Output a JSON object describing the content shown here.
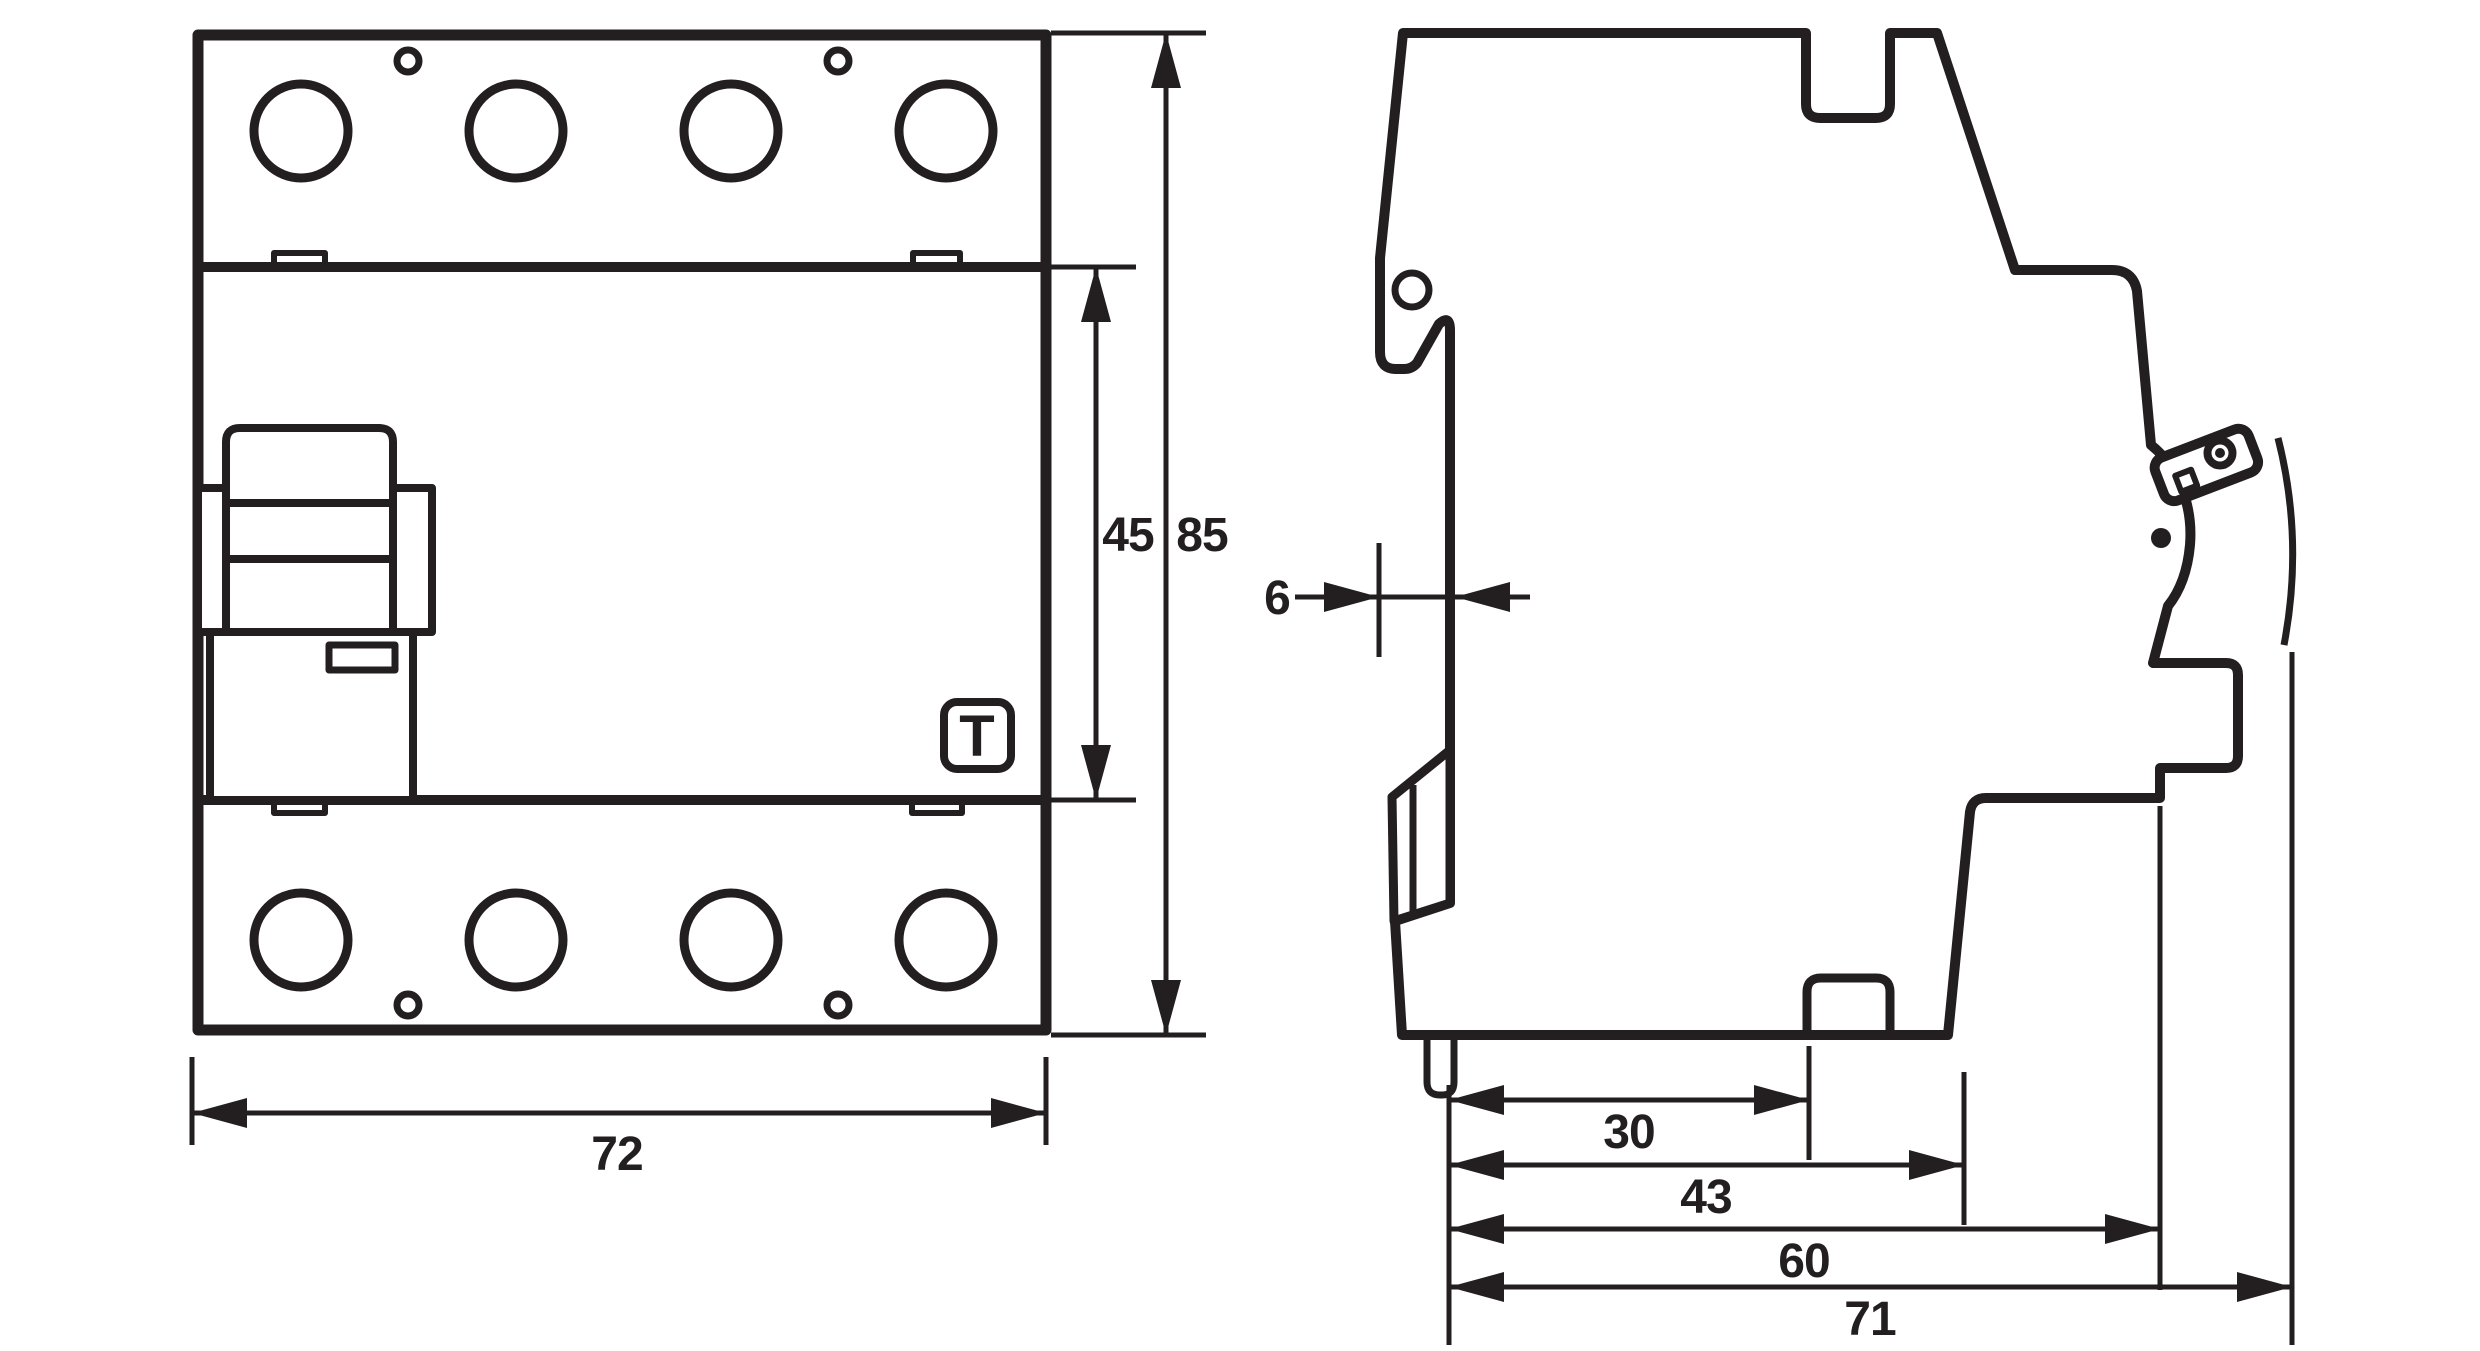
{
  "drawing": {
    "stroke_color": "#231f20",
    "background": "#ffffff",
    "front_view": {
      "test_button_label": "T",
      "width_mm": "72",
      "middle_section_height_mm": "45",
      "total_height_mm": "85"
    },
    "side_view": {
      "rail_recess_depth_mm": "6",
      "depth_to_notch_mm": "30",
      "depth_to_lower_step_mm": "43",
      "depth_to_front_face_mm": "60",
      "overall_depth_mm": "71"
    }
  }
}
